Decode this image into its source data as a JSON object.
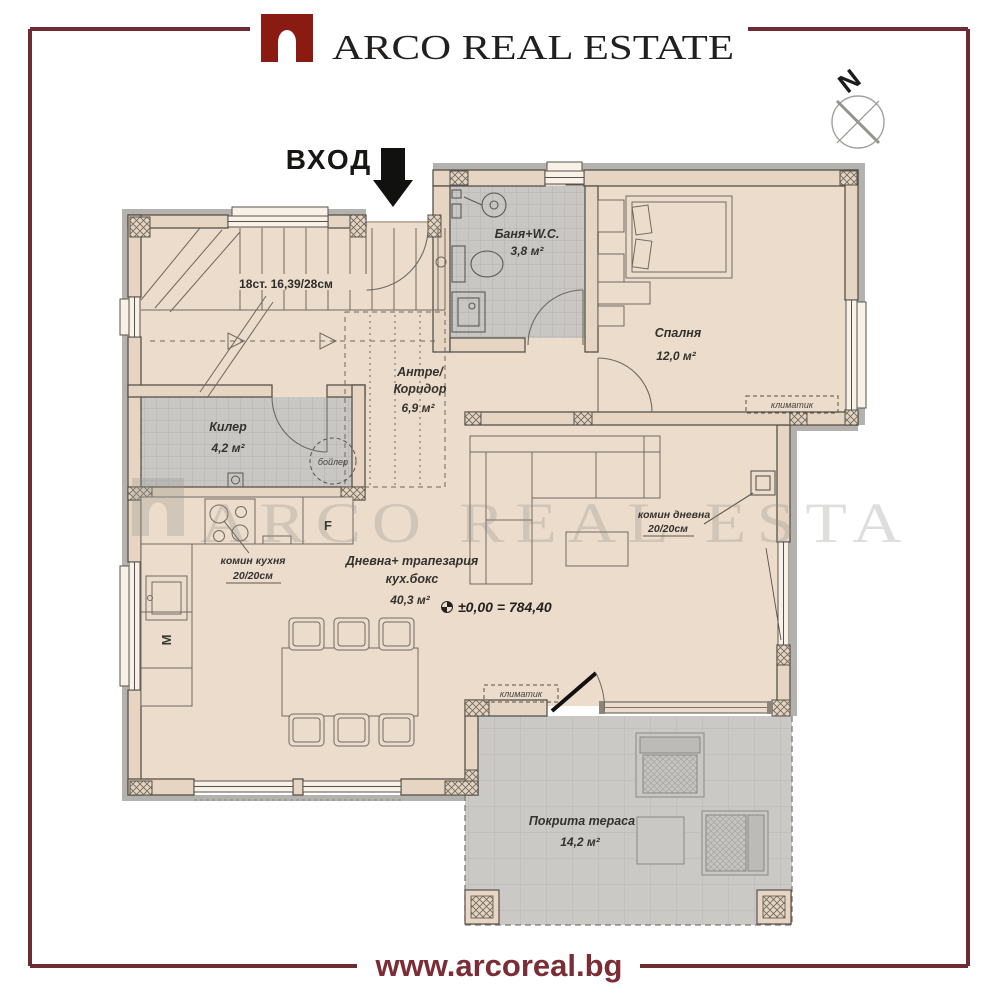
{
  "brand": {
    "name": "ARCO REAL ESTATE",
    "website": "www.arcoreal.bg"
  },
  "compass": {
    "north": "N"
  },
  "entrance_label": "ВХОД",
  "watermark": "ARCO REAL ESTA",
  "colors": {
    "frame_red": "#6e2b33",
    "logo_red": "#8a1b12",
    "floor_beige": "#ecdccb",
    "tile_gray": "#c9c7c4"
  },
  "rooms": {
    "bathroom": {
      "name": "Баня+W.C.",
      "area": "3,8 м²"
    },
    "bedroom": {
      "name": "Спалня",
      "area": "12,0 м²"
    },
    "hallway": {
      "name_line1": "Антре/",
      "name_line2": "Коридор",
      "area": "6,9 м²"
    },
    "closet": {
      "name": "Килер",
      "area": "4,2 м²"
    },
    "living_room": {
      "name_line1": "Дневна+ трапезария",
      "name_line2": "кух.бокс",
      "area": "40,3 м²"
    },
    "terrace": {
      "name": "Покрита тераса",
      "area": "14,2 м²"
    }
  },
  "annotations": {
    "stairs": "18ст. 16,39/28см",
    "boiler": "бойлер",
    "ac_unit": "климатик",
    "chimney_kitchen": {
      "label": "комин кухня",
      "size": "20/20см"
    },
    "chimney_living": {
      "label": "комин дневна",
      "size": "20/20см"
    },
    "level_mark": "±0,00 = 784,40",
    "fridge": "F",
    "washing_machine": "M"
  }
}
